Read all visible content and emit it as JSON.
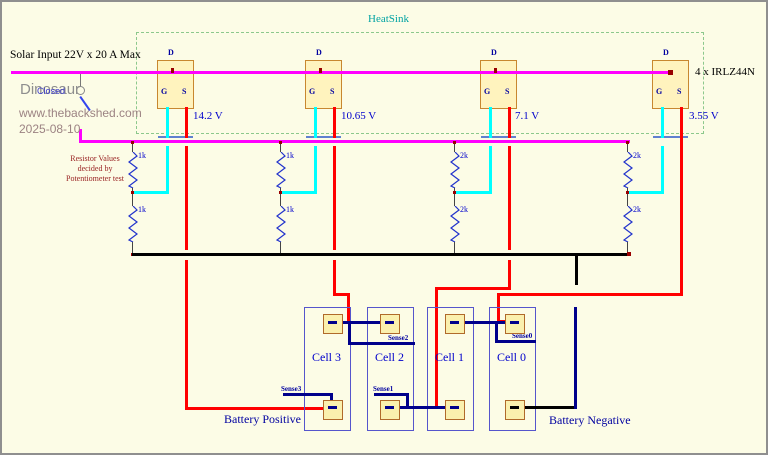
{
  "colors": {
    "background": "#FCFCE6",
    "solar_rail": "#FF00FF",
    "source_wire": "#FF0000",
    "gate_wire": "#00FFFF",
    "battery_wire": "#00008B",
    "ground_bus": "#000000",
    "heatsink_outline": "#8CC88C",
    "heatsink_text": "#00A3A3",
    "label_blue": "#0000CC",
    "note_red": "#992222",
    "junction_dot": "#990000",
    "mosfet_fill": "#FFF3BE",
    "mosfet_border": "#C8872F",
    "cell_border": "#5555CC",
    "watermark_gray": "#8E8E8E",
    "watermark_brown": "#9C8383"
  },
  "header": {
    "heatsink_label": "HeatSink",
    "solar_input_label": "Solar Input 22V x 20 A Max",
    "mosfet_part_label": "4 x IRLZ44N"
  },
  "watermark": {
    "name": "Dinosaur",
    "switch_state": "Closed",
    "website": "www.thebackshed.com",
    "date": "2025-08-10"
  },
  "note": {
    "line1": "Resistor Values",
    "line2": "decided by",
    "line3": "Potentiometer test"
  },
  "mosfets": [
    {
      "drain_label": "D",
      "gate_label": "G",
      "source_label": "S",
      "source_voltage": "14.2 V"
    },
    {
      "drain_label": "D",
      "gate_label": "G",
      "source_label": "S",
      "source_voltage": "10.65 V"
    },
    {
      "drain_label": "D",
      "gate_label": "G",
      "source_label": "S",
      "source_voltage": "7.1 V"
    },
    {
      "drain_label": "D",
      "gate_label": "G",
      "source_label": "S",
      "source_voltage": "3.55 V"
    }
  ],
  "dividers": [
    {
      "top_resistor": "1k",
      "bottom_resistor": "1k"
    },
    {
      "top_resistor": "1k",
      "bottom_resistor": "1k"
    },
    {
      "top_resistor": "2k",
      "bottom_resistor": "2k"
    },
    {
      "top_resistor": "2k",
      "bottom_resistor": "2k"
    }
  ],
  "cells": [
    {
      "label": "Cell 3",
      "sense": "Sense3"
    },
    {
      "label": "Cell 2",
      "sense": "Sense2"
    },
    {
      "label": "Cell 1",
      "sense": "Sense1"
    },
    {
      "label": "Cell 0",
      "sense": "Sense0"
    }
  ],
  "battery": {
    "positive_label": "Battery Positive",
    "negative_label": "Battery Negative"
  }
}
